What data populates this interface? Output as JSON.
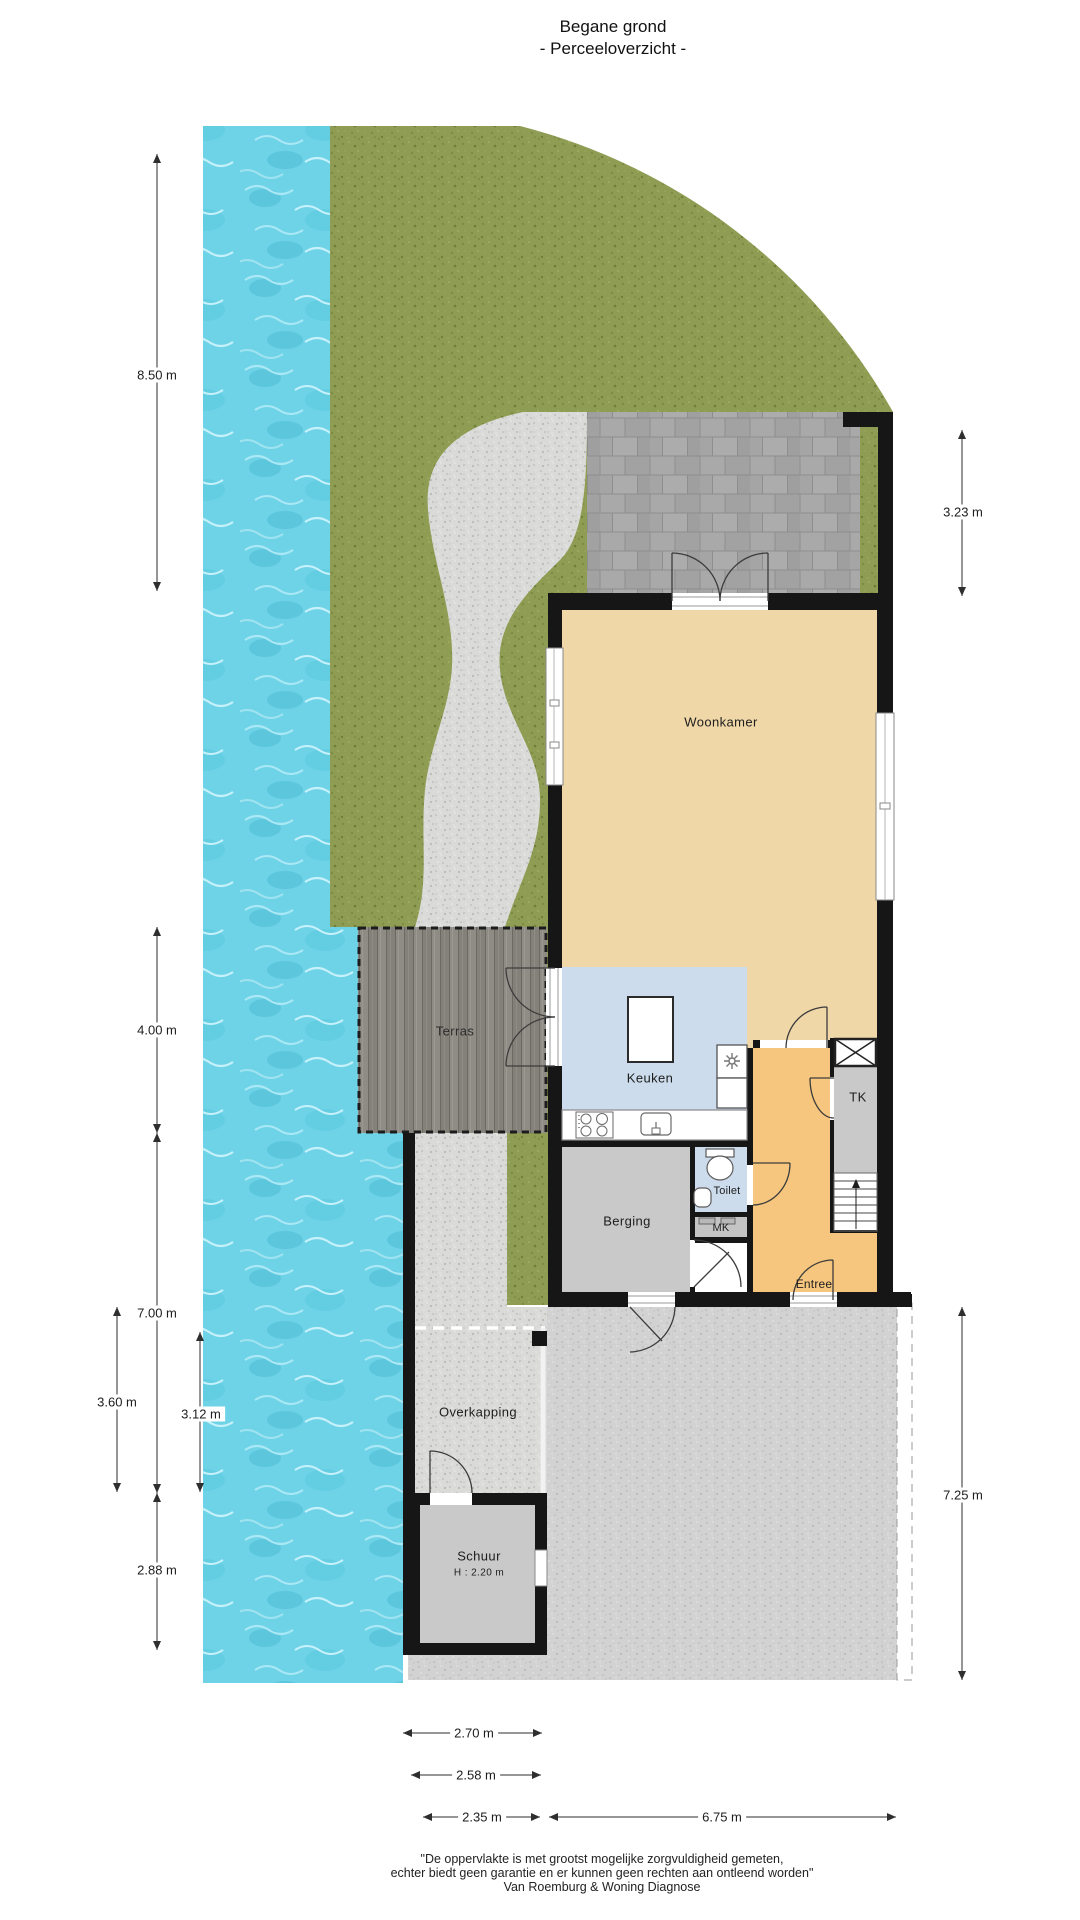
{
  "title": {
    "line1": "Begane grond",
    "line2": "- Perceeloverzicht -"
  },
  "labels": {
    "woonkamer": "Woonkamer",
    "keuken": "Keuken",
    "terras": "Terras",
    "berging": "Berging",
    "toilet": "Toilet",
    "mk": "MK",
    "tk": "TK",
    "entree": "Entree",
    "overkapping": "Overkapping",
    "schuur": "Schuur",
    "schuur_height": "H : 2.20 m"
  },
  "dims": {
    "d850": "8.50 m",
    "d323": "3.23 m",
    "d400": "4.00 m",
    "d700": "7.00 m",
    "d360": "3.60 m",
    "d312": "3.12 m",
    "d288": "2.88 m",
    "d725": "7.25 m",
    "d270": "2.70 m",
    "d258": "2.58 m",
    "d235": "2.35 m",
    "d675": "6.75 m"
  },
  "footer": {
    "line1": "\"De oppervlakte is met grootst mogelijke zorgvuldigheid gemeten,",
    "line2": "echter biedt geen garantie en er kunnen geen rechten aan ontleend worden\"",
    "line3": "Van Roemburg & Woning Diagnose"
  },
  "colors": {
    "water": "#6fd3e8",
    "grass": "#8f9c53",
    "gravel": "#dadad8",
    "paving": "#d2d2d2",
    "patio_tile": "#a6a6a6",
    "deck": "#8b8880",
    "wall": "#161616",
    "floor_living": "#f0d7a8",
    "floor_entree": "#f6c67e",
    "floor_wet": "#ccdcec",
    "floor_storage": "#c9c9c9"
  }
}
